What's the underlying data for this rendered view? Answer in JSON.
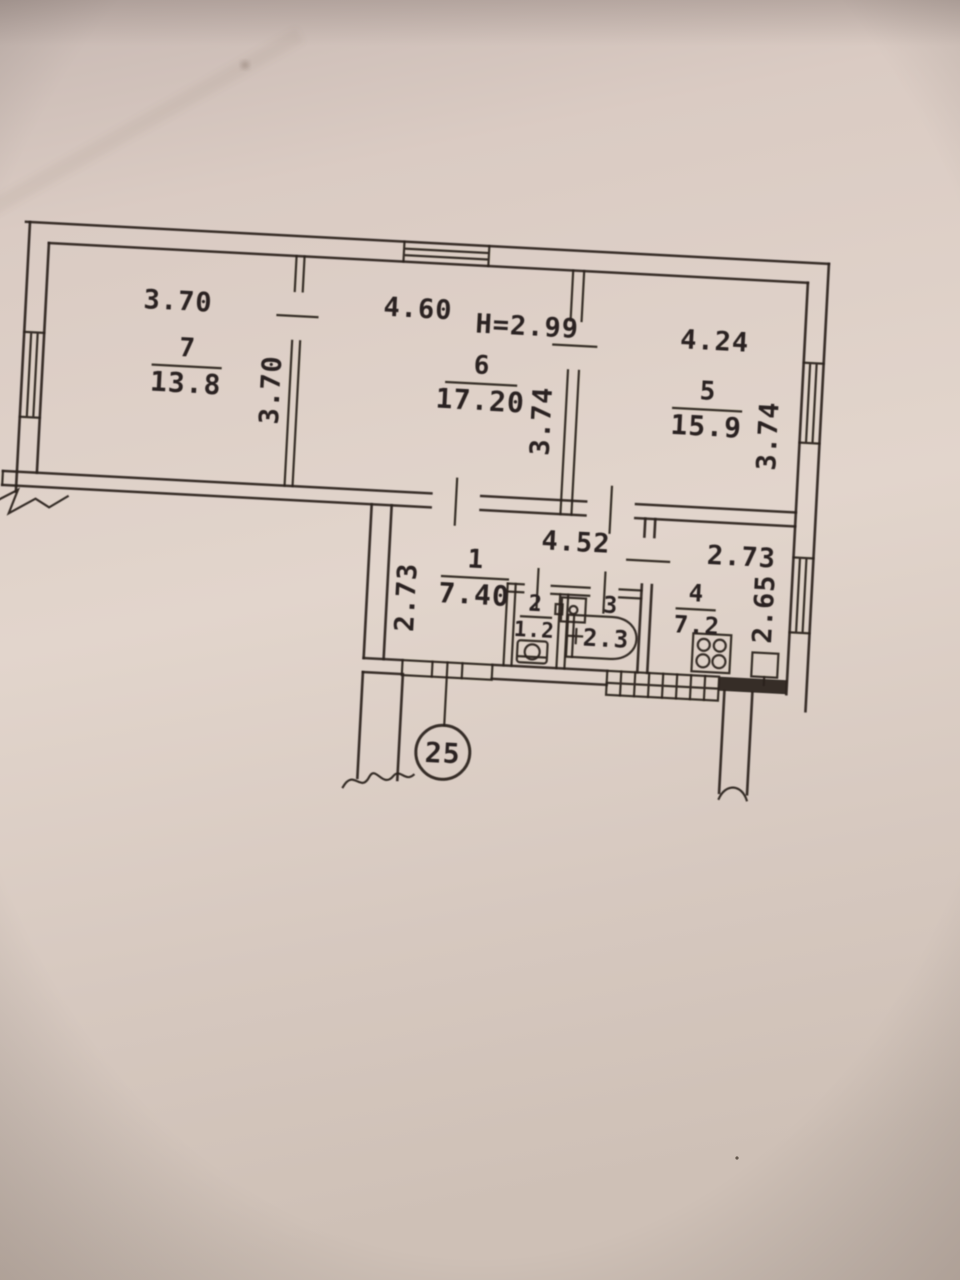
{
  "plan": {
    "document_type": "apartment-floor-plan-photo",
    "apartment_number": "25",
    "ceiling_height": "H=2.99",
    "rooms": [
      {
        "number": "7",
        "area": "13.8",
        "width": "3.70",
        "depth": "3.70"
      },
      {
        "number": "6",
        "area": "17.20",
        "width": "4.60",
        "depth": "3.74"
      },
      {
        "number": "5",
        "area": "15.9",
        "width": "4.24",
        "depth": "3.74"
      },
      {
        "number": "1",
        "area": "7.40",
        "width": "4.52",
        "depth": "2.73"
      },
      {
        "number": "2",
        "area": "1.2"
      },
      {
        "number": "3",
        "area": "2.3"
      },
      {
        "number": "4",
        "area": "7.2",
        "width": "2.73",
        "depth": "2.65"
      }
    ],
    "fixtures": [
      "toilet",
      "washbasin",
      "bathtub",
      "stove-4-burner",
      "kitchen-sink"
    ],
    "colors": {
      "ink": "#2a2420",
      "paper": "#d9cac2"
    }
  }
}
